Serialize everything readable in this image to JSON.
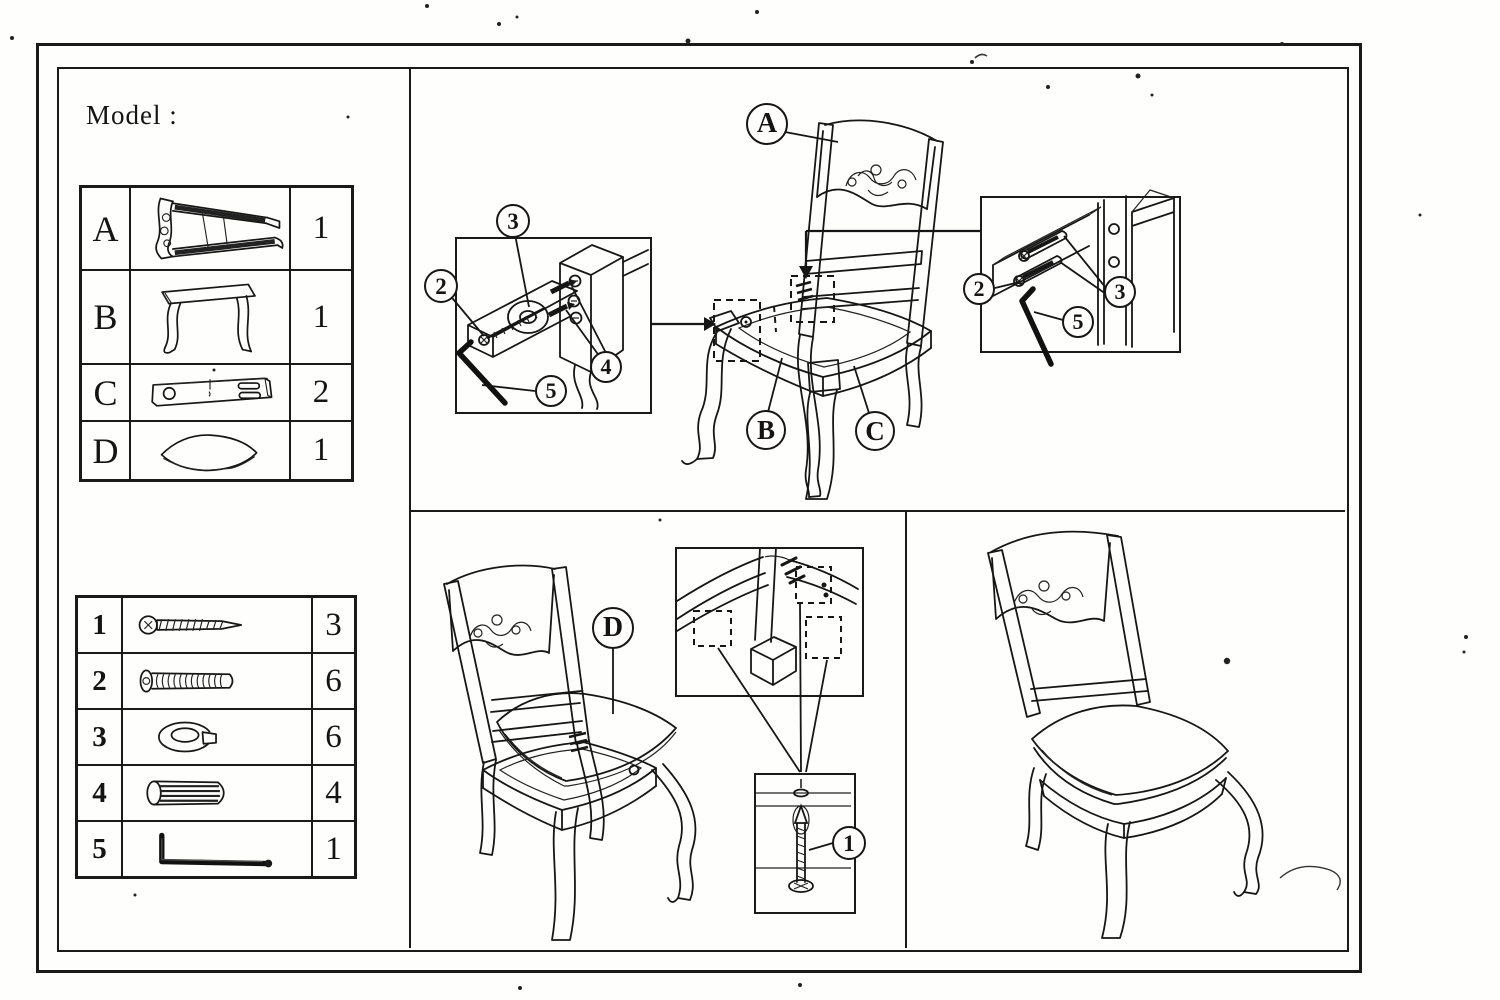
{
  "header": {
    "model_label": "Model :"
  },
  "parts_table": {
    "rows": [
      {
        "letter": "A",
        "qty": "1",
        "icon": "chair-back-frame"
      },
      {
        "letter": "B",
        "qty": "1",
        "icon": "front-leg-frame"
      },
      {
        "letter": "C",
        "qty": "2",
        "icon": "side-rail-bracket"
      },
      {
        "letter": "D",
        "qty": "1",
        "icon": "seat-cushion"
      }
    ]
  },
  "hardware_table": {
    "rows": [
      {
        "num": "1",
        "qty": "3",
        "icon": "wood-screw"
      },
      {
        "num": "2",
        "qty": "6",
        "icon": "machine-bolt"
      },
      {
        "num": "3",
        "qty": "6",
        "icon": "lock-washer"
      },
      {
        "num": "4",
        "qty": "4",
        "icon": "wood-dowel"
      },
      {
        "num": "5",
        "qty": "1",
        "icon": "allen-key"
      }
    ]
  },
  "callouts": {
    "a": "A",
    "b": "B",
    "c": "C",
    "d": "D",
    "n1": "1",
    "n2": "2",
    "n3": "3",
    "n4": "4",
    "n5": "5"
  }
}
